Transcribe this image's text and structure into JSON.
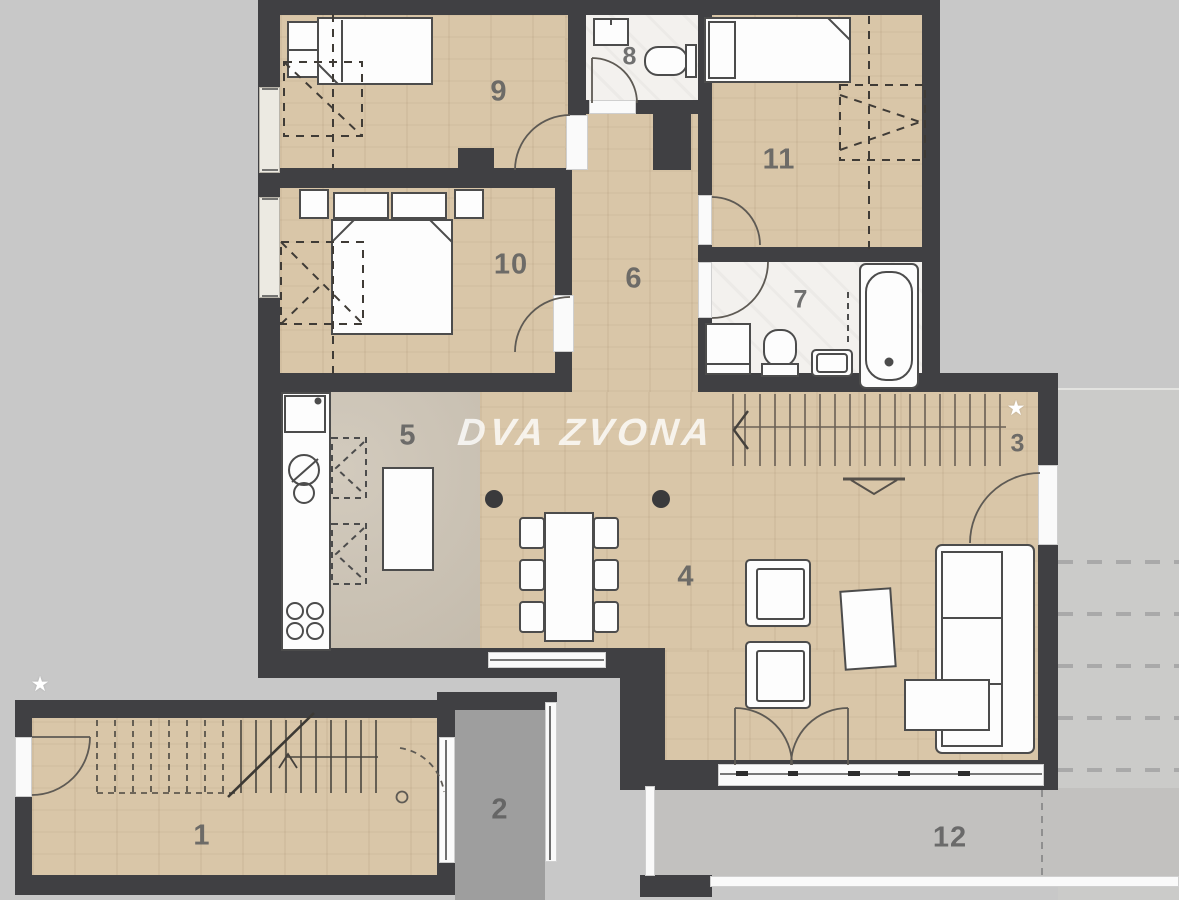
{
  "watermark": {
    "text": "DVA ZVONA"
  },
  "rooms": [
    {
      "number": "1"
    },
    {
      "number": "2"
    },
    {
      "number": "3"
    },
    {
      "number": "4"
    },
    {
      "number": "5"
    },
    {
      "number": "6"
    },
    {
      "number": "7"
    },
    {
      "number": "8"
    },
    {
      "number": "9"
    },
    {
      "number": "10"
    },
    {
      "number": "11"
    },
    {
      "number": "12"
    }
  ],
  "markers": {
    "star": "★"
  },
  "palette": {
    "wall": "#404043",
    "wood_floor": "#d9c6a8",
    "kitchen_floor": "#ccc3b4",
    "bath_floor": "#f3f1ee",
    "terrace_small": "#9e9e9e",
    "terrace_large": "#c2c1bf",
    "exterior": "#c8c8c8",
    "watermark_text": "#ffffff"
  }
}
